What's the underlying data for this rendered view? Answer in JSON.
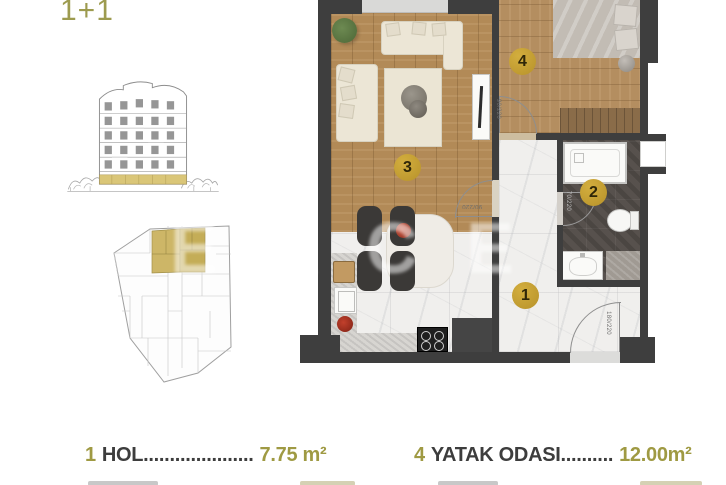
{
  "title": "1+1",
  "watermark": "TEKCE",
  "colors": {
    "badge_gold": "#bf9b2e",
    "legend_gold": "#9f9a43",
    "title_gold": "#9d9b4f",
    "wall": "#3e3e3e"
  },
  "plan": {
    "badges": [
      {
        "id": "hall",
        "number": "1"
      },
      {
        "id": "bathroom",
        "number": "2"
      },
      {
        "id": "living-room",
        "number": "3"
      },
      {
        "id": "bedroom",
        "number": "4"
      }
    ],
    "door_labels": {
      "bedroom_door": "90/220",
      "living_door": "90/220",
      "bath_door": "70/220",
      "entrance_door": "180/220"
    }
  },
  "legend": {
    "items": [
      {
        "number": "1",
        "name": "HOL",
        "dots": ".....................",
        "area": "7.75 m²"
      },
      {
        "number": "4",
        "name": "YATAK ODASI",
        "dots": "..........",
        "area": "12.00m²"
      }
    ]
  }
}
